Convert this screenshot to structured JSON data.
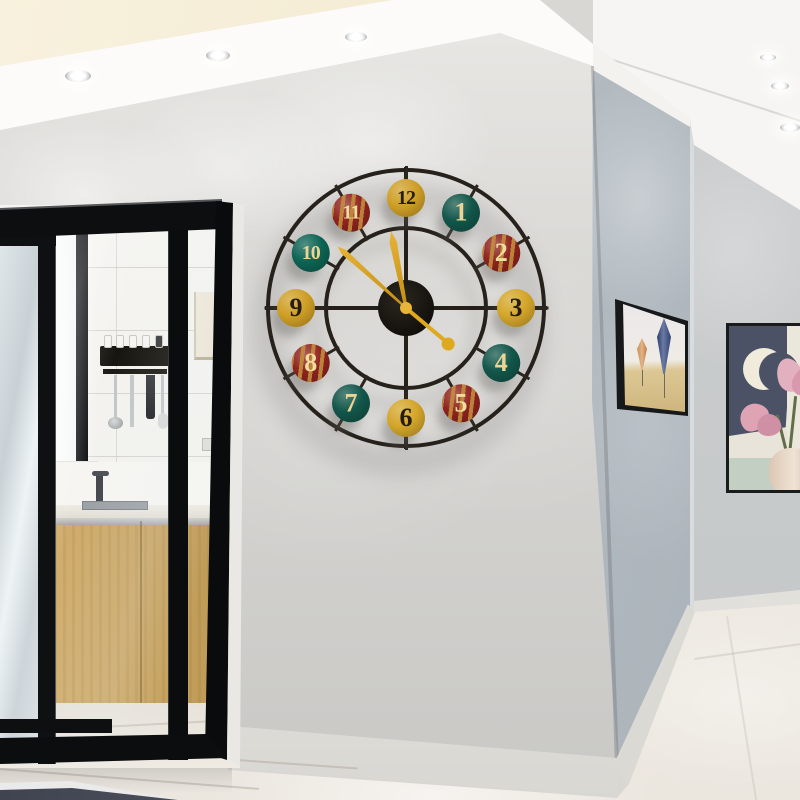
{
  "scene": {
    "description": "Modern apartment corner: large round metal wall clock on a light grey wall, kitchen seen through black-framed sliding glass doors on the left, hallway with two framed artworks on the right, recessed ceiling spotlights, cream marble floor",
    "wall_clock_time": "11:52",
    "palette": {
      "main_wall": "#d8d7d4",
      "side_wall": "#b4bcc2",
      "far_wall": "#c7cacb",
      "ceiling": "#f4f3f1",
      "ceiling_recess_cream": "#f3ecd3",
      "floor_marble": "#efebe4",
      "door_frame_black": "#0d0e10",
      "cabinet_wood": "#c9a562",
      "clock_metal": "#26211b",
      "clock_gold": "#d9a11f"
    }
  },
  "clock": {
    "disc_radius": 110,
    "time": "11:52",
    "seconds": 22,
    "hands": {
      "hour": {
        "angle": -11,
        "color": "#d9a11f"
      },
      "minute": {
        "angle": -48,
        "color": "#d9a11f"
      },
      "second": {
        "angle": 130,
        "color": "#dfa91f"
      }
    },
    "discs": [
      {
        "label": "12",
        "angle": 0,
        "color": "#cf9f26",
        "number_color": "#261d0c",
        "striped": false
      },
      {
        "label": "1",
        "angle": 30,
        "color": "#12564a",
        "number_color": "#ecd594",
        "striped": false
      },
      {
        "label": "2",
        "angle": 60,
        "color": "#8f231e",
        "number_color": "#f0dc9c",
        "striped": true
      },
      {
        "label": "3",
        "angle": 90,
        "color": "#d4a62a",
        "number_color": "#261d0c",
        "striped": false
      },
      {
        "label": "4",
        "angle": 120,
        "color": "#12564a",
        "number_color": "#ecd594",
        "striped": false
      },
      {
        "label": "5",
        "angle": 150,
        "color": "#8f231e",
        "number_color": "#f0dc9c",
        "striped": true
      },
      {
        "label": "6",
        "angle": 180,
        "color": "#d4a62a",
        "number_color": "#261d0c",
        "striped": false
      },
      {
        "label": "7",
        "angle": 210,
        "color": "#12564a",
        "number_color": "#ecd594",
        "striped": false
      },
      {
        "label": "8",
        "angle": 240,
        "color": "#8f231e",
        "number_color": "#f0dc9c",
        "striped": true
      },
      {
        "label": "9",
        "angle": 270,
        "color": "#cf9f26",
        "number_color": "#261d0c",
        "striped": false
      },
      {
        "label": "10",
        "angle": 300,
        "color": "#0d6455",
        "number_color": "#ecd594",
        "striped": false
      },
      {
        "label": "11",
        "angle": 330,
        "color": "#8f231e",
        "number_color": "#f0dc9c",
        "striped": true
      }
    ]
  },
  "lights": {
    "soffit_spotlights": [
      {
        "x": 78,
        "y": 76,
        "w": 26,
        "h": 12
      },
      {
        "x": 218,
        "y": 55,
        "w": 24,
        "h": 11
      },
      {
        "x": 356,
        "y": 37,
        "w": 22,
        "h": 10
      }
    ],
    "hallway_spotlights": [
      {
        "x": 768,
        "y": 57,
        "w": 16,
        "h": 7
      },
      {
        "x": 780,
        "y": 86,
        "w": 18,
        "h": 8
      },
      {
        "x": 790,
        "y": 127,
        "w": 20,
        "h": 9
      }
    ]
  },
  "artworks": [
    {
      "name": "balloon-art",
      "subject": "two elongated hot-air balloons over sand dunes",
      "frame": "black box frame, viewed at sharp angle",
      "colors": [
        "#eae7ea",
        "#ccb279",
        "#2e3f6e",
        "#cf9057"
      ]
    },
    {
      "name": "moon-flower-art",
      "subject": "crescent moon on navy with pink magnolia flowers in a vase",
      "frame": "thin black frame, partially cut off by image edge",
      "colors": [
        "#4b5266",
        "#f0ebdb",
        "#e3b0bf",
        "#c4cfc4",
        "#dcc6b3"
      ]
    }
  ],
  "kitchen": {
    "items": [
      "bright window",
      "white tiled wall",
      "black utensil rack with cups and hanging ladle, whisk, knife, spatula",
      "cream upper cabinet",
      "power outlet",
      "dark faucet and sink",
      "white bowl with red and orange fruit",
      "light oak base cabinets with steel handle rail",
      "marble floor"
    ]
  }
}
